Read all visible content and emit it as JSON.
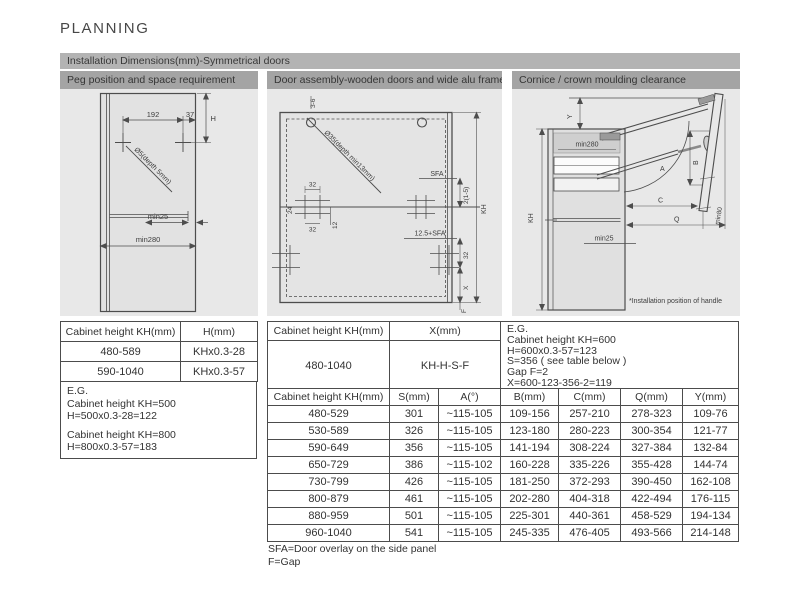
{
  "title": "PLANNING",
  "banner": {
    "label": "Installation Dimensions(mm)-Symmetrical doors"
  },
  "panels": {
    "peg": {
      "header": "Peg position and space requirement",
      "labels": {
        "dim_192": "192",
        "dim_37": "37",
        "dim_h": "H",
        "hole": "Ø5(depth 5mm)",
        "min25": "min25",
        "min280": "min280"
      }
    },
    "door": {
      "header": "Door assembly-wooden doors and wide alu frames",
      "labels": {
        "dim_3_6": "3-6",
        "hole": "Ø35(depth min13mm)",
        "sfa": "SFA",
        "dim_2_1_5": "2(1-5)",
        "kh": "KH",
        "dim_24": "24",
        "dim_32_top": "32",
        "dim_32_bottom": "32",
        "dim_12": "12",
        "dim_125_sfa": "12.5+SFA",
        "dim_32_right": "32",
        "dim_x": "X",
        "dim_f": "F"
      }
    },
    "cornice": {
      "header": "Cornice / crown moulding clearance",
      "labels": {
        "dim_y": "Y",
        "min280": "min280",
        "kh": "KH",
        "min25": "min25",
        "dim_a": "A",
        "dim_b": "B",
        "dim_c": "C",
        "dim_q": "Q",
        "min80": "min80",
        "note": "*Installation position of handle"
      }
    }
  },
  "left_table": {
    "headers": [
      "Cabinet height KH(mm)",
      "H(mm)"
    ],
    "rows": [
      [
        "480-589",
        "KHx0.3-28"
      ],
      [
        "590-1040",
        "KHx0.3-57"
      ]
    ],
    "example": [
      "E.G.",
      "Cabinet height KH=500",
      "H=500x0.3-28=122",
      "Cabinet height KH=800",
      "H=800x0.3-57=183"
    ]
  },
  "x_table": {
    "headers": [
      "Cabinet height KH(mm)",
      "X(mm)"
    ],
    "row": [
      "480-1040",
      "KH-H-S-F"
    ],
    "example": [
      "E.G.",
      "Cabinet height KH=600",
      "H=600x0.3-57=123",
      "S=356 ( see table below )",
      "Gap F=2",
      "X=600-123-356-2=119"
    ]
  },
  "main_table": {
    "headers": [
      "Cabinet height KH(mm)",
      "S(mm)",
      "A(°)",
      "B(mm)",
      "C(mm)",
      "Q(mm)",
      "Y(mm)"
    ],
    "rows": [
      [
        "480-529",
        "301",
        "~115-105",
        "109-156",
        "257-210",
        "278-323",
        "109-76"
      ],
      [
        "530-589",
        "326",
        "~115-105",
        "123-180",
        "280-223",
        "300-354",
        "121-77"
      ],
      [
        "590-649",
        "356",
        "~115-105",
        "141-194",
        "308-224",
        "327-384",
        "132-84"
      ],
      [
        "650-729",
        "386",
        "~115-102",
        "160-228",
        "335-226",
        "355-428",
        "144-74"
      ],
      [
        "730-799",
        "426",
        "~115-105",
        "181-250",
        "372-293",
        "390-450",
        "162-108"
      ],
      [
        "800-879",
        "461",
        "~115-105",
        "202-280",
        "404-318",
        "422-494",
        "176-115"
      ],
      [
        "880-959",
        "501",
        "~115-105",
        "225-301",
        "440-361",
        "458-529",
        "194-134"
      ],
      [
        "960-1040",
        "541",
        "~115-105",
        "245-335",
        "476-405",
        "493-566",
        "214-148"
      ]
    ],
    "footnotes": [
      "SFA=Door overlay on the side panel",
      "F=Gap"
    ]
  },
  "colors": {
    "banner_bg": "#b3b3b3",
    "panel_header_bg": "#a4a4a4",
    "diagram_bg": "#e8e8e8",
    "line": "#4d4d4d"
  }
}
